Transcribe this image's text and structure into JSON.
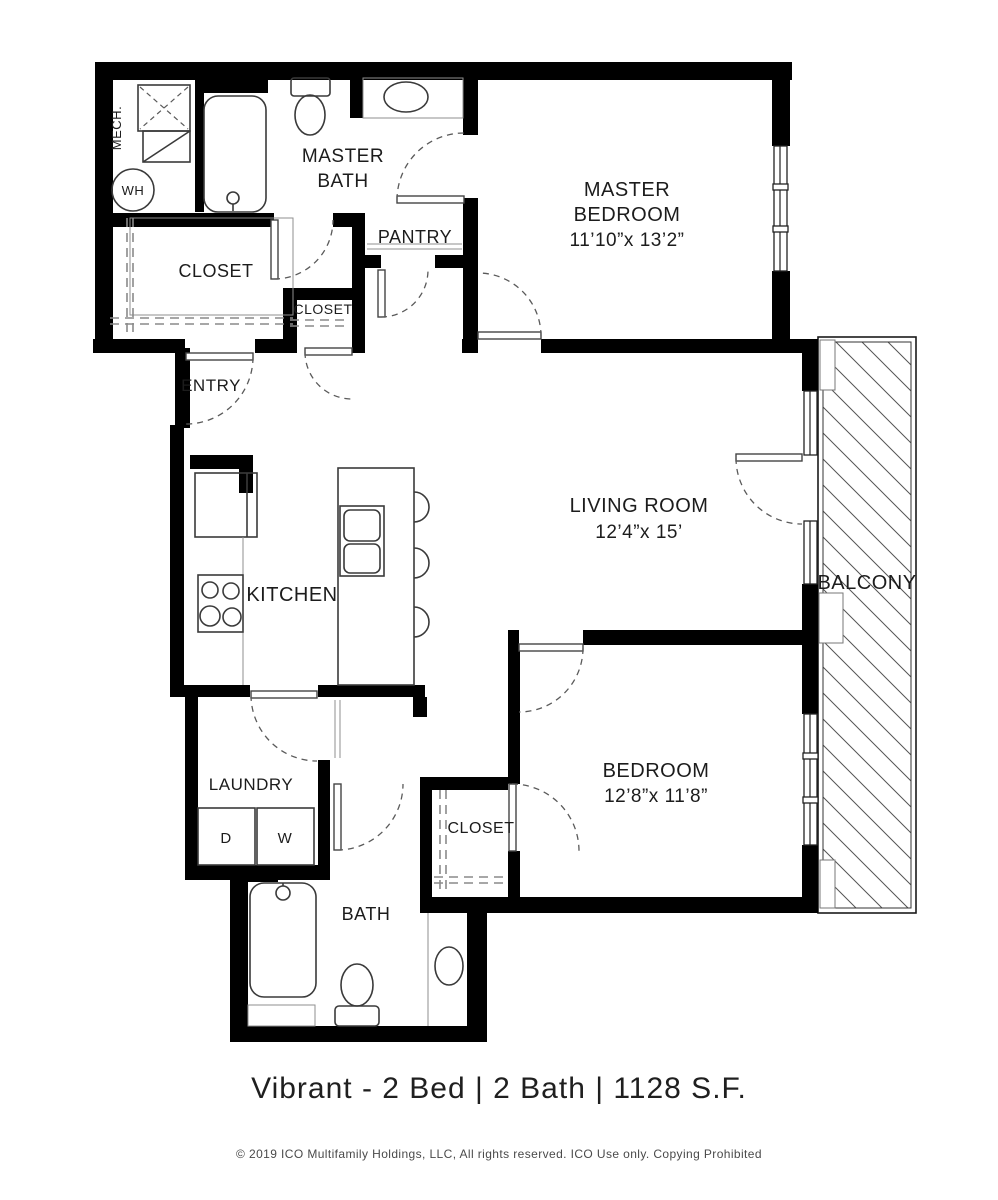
{
  "title": "Vibrant - 2 Bed | 2 Bath | 1128 S.F.",
  "footer": "© 2019 ICO Multifamily Holdings, LLC, All rights reserved.  ICO Use only.  Copying Prohibited",
  "colors": {
    "wall": "#000000",
    "background": "#ffffff",
    "fixture_line": "#3a3a3a",
    "door_arc": "#5a5a5a",
    "text": "#1c1c1c",
    "footer_text": "#4a4a4a"
  },
  "rooms": {
    "mech": {
      "label": "MECH."
    },
    "water_heater": {
      "label": "WH"
    },
    "master_bath": {
      "line1": "MASTER",
      "line2": "BATH"
    },
    "pantry": {
      "label": "PANTRY"
    },
    "master_closet": {
      "label": "CLOSET"
    },
    "hall_closet": {
      "label": "CLOSET"
    },
    "entry": {
      "label": "ENTRY"
    },
    "master_bedroom": {
      "line1": "MASTER",
      "line2": "BEDROOM",
      "dims": "11’10”x 13’2”"
    },
    "living_room": {
      "line1": "LIVING ROOM",
      "dims": "12’4”x 15’"
    },
    "kitchen": {
      "label": "KITCHEN"
    },
    "balcony": {
      "label": "BALCONY"
    },
    "laundry": {
      "label": "LAUNDRY",
      "dryer": "D",
      "washer": "W"
    },
    "bedroom": {
      "line1": "BEDROOM",
      "dims": "12’8”x 11’8”"
    },
    "bedroom_closet": {
      "label": "CLOSET"
    },
    "bath": {
      "label": "BATH"
    }
  }
}
